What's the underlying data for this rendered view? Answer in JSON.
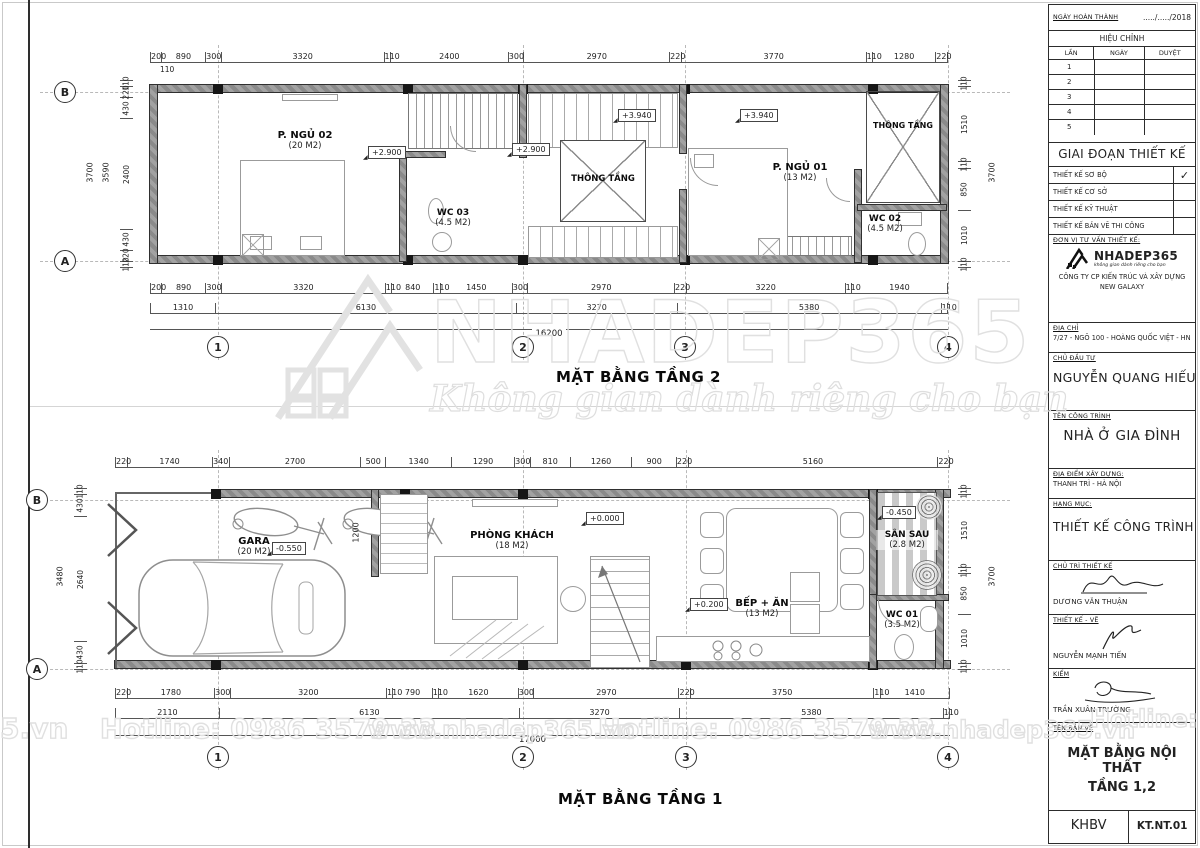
{
  "sheet": {
    "floor2_title": "MẶT BẰNG TẦNG 2",
    "floor1_title": "MẶT BẰNG TẦNG 1"
  },
  "grid": {
    "cols": [
      "1",
      "2",
      "3",
      "4"
    ],
    "rows": [
      "B",
      "A"
    ]
  },
  "floor2": {
    "rooms": [
      {
        "name": "P. NGỦ 02",
        "area": "(20 M2)"
      },
      {
        "name": "WC 03",
        "area": "(4.5 M2)"
      },
      {
        "name": "THÔNG TẦNG",
        "area": ""
      },
      {
        "name": "P. NGỦ 01",
        "area": "(13 M2)"
      },
      {
        "name": "WC 02",
        "area": "(4.5 M2)"
      },
      {
        "name": "THÔNG TẦNG",
        "area": ""
      }
    ],
    "levels": [
      "+2.900",
      "+2.900",
      "+3.940",
      "+3.940"
    ],
    "dims_top": [
      "200",
      "890",
      "300",
      "3320",
      "110",
      "2400",
      "300",
      "2970",
      "220",
      "3770",
      "110",
      "1280",
      "220"
    ],
    "dim_sub": "110",
    "dims_bottom1": [
      "200",
      "890",
      "300",
      "3320",
      "110",
      "840",
      "110",
      "1450",
      "300",
      "2970",
      "220",
      "3220",
      "110",
      "1940"
    ],
    "dims_bottom2": [
      "1310",
      "6130",
      "3270",
      "5380",
      "110"
    ],
    "dim_total": "16200",
    "dims_left": [
      "110",
      "220",
      "430",
      "2400",
      "430",
      "220",
      "110"
    ],
    "left_total1": "3590",
    "left_total2": "3700",
    "dims_right": [
      "110",
      "1510",
      "110",
      "850",
      "1010",
      "110"
    ],
    "right_total": "3700"
  },
  "floor1": {
    "rooms": [
      {
        "name": "GARA",
        "area": "(20 M2)"
      },
      {
        "name": "PHÒNG KHÁCH",
        "area": "(18 M2)"
      },
      {
        "name": "BẾP + ĂN",
        "area": "(13 M2)"
      },
      {
        "name": "WC 01",
        "area": "(3.5 M2)"
      },
      {
        "name": "SÂN SAU",
        "area": "(2.8 M2)"
      }
    ],
    "levels": [
      "-0.550",
      "+0.000",
      "+0.200",
      "-0.450"
    ],
    "inner_dim": "1200",
    "dims_top": [
      "220",
      "1740",
      "340",
      "2700",
      "500",
      "1340",
      "1290",
      "300",
      "810",
      "1260",
      "900",
      "220",
      "5160",
      "220"
    ],
    "dims_bottom1": [
      "220",
      "1780",
      "300",
      "3200",
      "110",
      "790",
      "110",
      "1620",
      "300",
      "2970",
      "220",
      "3750",
      "110",
      "1410"
    ],
    "dims_bottom2": [
      "2110",
      "6130",
      "3270",
      "5380",
      "110"
    ],
    "dim_total": "17000",
    "dims_left": [
      "110",
      "430",
      "2640",
      "430",
      "110"
    ],
    "left_total": "3480",
    "dims_right": [
      "110",
      "1510",
      "110",
      "850",
      "1010",
      "110"
    ],
    "right_total": "3700"
  },
  "watermark": {
    "brand": "NHADEP365",
    "tagline": "Không gian dành riêng cho bạn",
    "hotline": "Hotline: 0986 3579 33",
    "website": "www.nhadep365.vn",
    "left_fragment": "5.vn",
    "right_fragment": "Hotline: 09"
  },
  "titleblock": {
    "completion": {
      "label": "NGÀY HOÀN THÀNH",
      "value": "...../...../2018"
    },
    "revision": {
      "title": "HIỆU CHỈNH",
      "cols": [
        "LẦN",
        "NGÀY",
        "DUYỆT"
      ],
      "rows": [
        "1",
        "2",
        "3",
        "4",
        "5"
      ]
    },
    "phase": {
      "title": "GIAI ĐOẠN THIẾT KẾ",
      "items": [
        {
          "label": "THIẾT KẾ SƠ BỘ",
          "check": "✓"
        },
        {
          "label": "THIẾT KẾ CƠ SỞ",
          "check": ""
        },
        {
          "label": "THIẾT KẾ KỸ THUẬT",
          "check": ""
        },
        {
          "label": "THIẾT KẾ BẢN VẼ THI CÔNG",
          "check": ""
        }
      ]
    },
    "consultant": {
      "label": "ĐƠN VỊ TƯ VẤN THIẾT KẾ:",
      "brand": "NHADEP365",
      "tagline": "không gian dành riêng cho bạn",
      "company": "CÔNG TY CP KIẾN TRÚC VÀ XÂY DỰNG NEW GALAXY"
    },
    "address": {
      "label": "ĐỊA CHỈ",
      "value": "7/27 - NGÕ 100 - HOÀNG QUỐC VIỆT - HN"
    },
    "owner": {
      "label": "CHỦ ĐẦU TƯ",
      "value": "NGUYỄN QUANG HIẾU"
    },
    "project": {
      "label": "TÊN CÔNG TRÌNH",
      "value": "NHÀ Ở GIA ĐÌNH"
    },
    "location": {
      "label": "ĐỊA ĐIỂM XÂY DỰNG:",
      "value": "THANH TRÌ - HÀ NỘI"
    },
    "category": {
      "label": "HẠNG MỤC:",
      "value": "THIẾT KẾ CÔNG TRÌNH"
    },
    "signatures": [
      {
        "label": "CHỦ TRÌ THIẾT KẾ",
        "name": "DƯƠNG VĂN THUẬN"
      },
      {
        "label": "THIẾT KẾ - VẼ",
        "name": "NGUYỄN MẠNH TIẾN"
      },
      {
        "label": "KIỂM",
        "name": "TRẦN XUÂN TRƯỜNG"
      }
    ],
    "drawing": {
      "label": "TÊN BẢN VẼ",
      "line1": "MẶT BẰNG NỘI THẤT",
      "line2": "TẦNG 1,2"
    },
    "footer": {
      "left": "KHBV",
      "right": "KT.NT.01"
    }
  }
}
